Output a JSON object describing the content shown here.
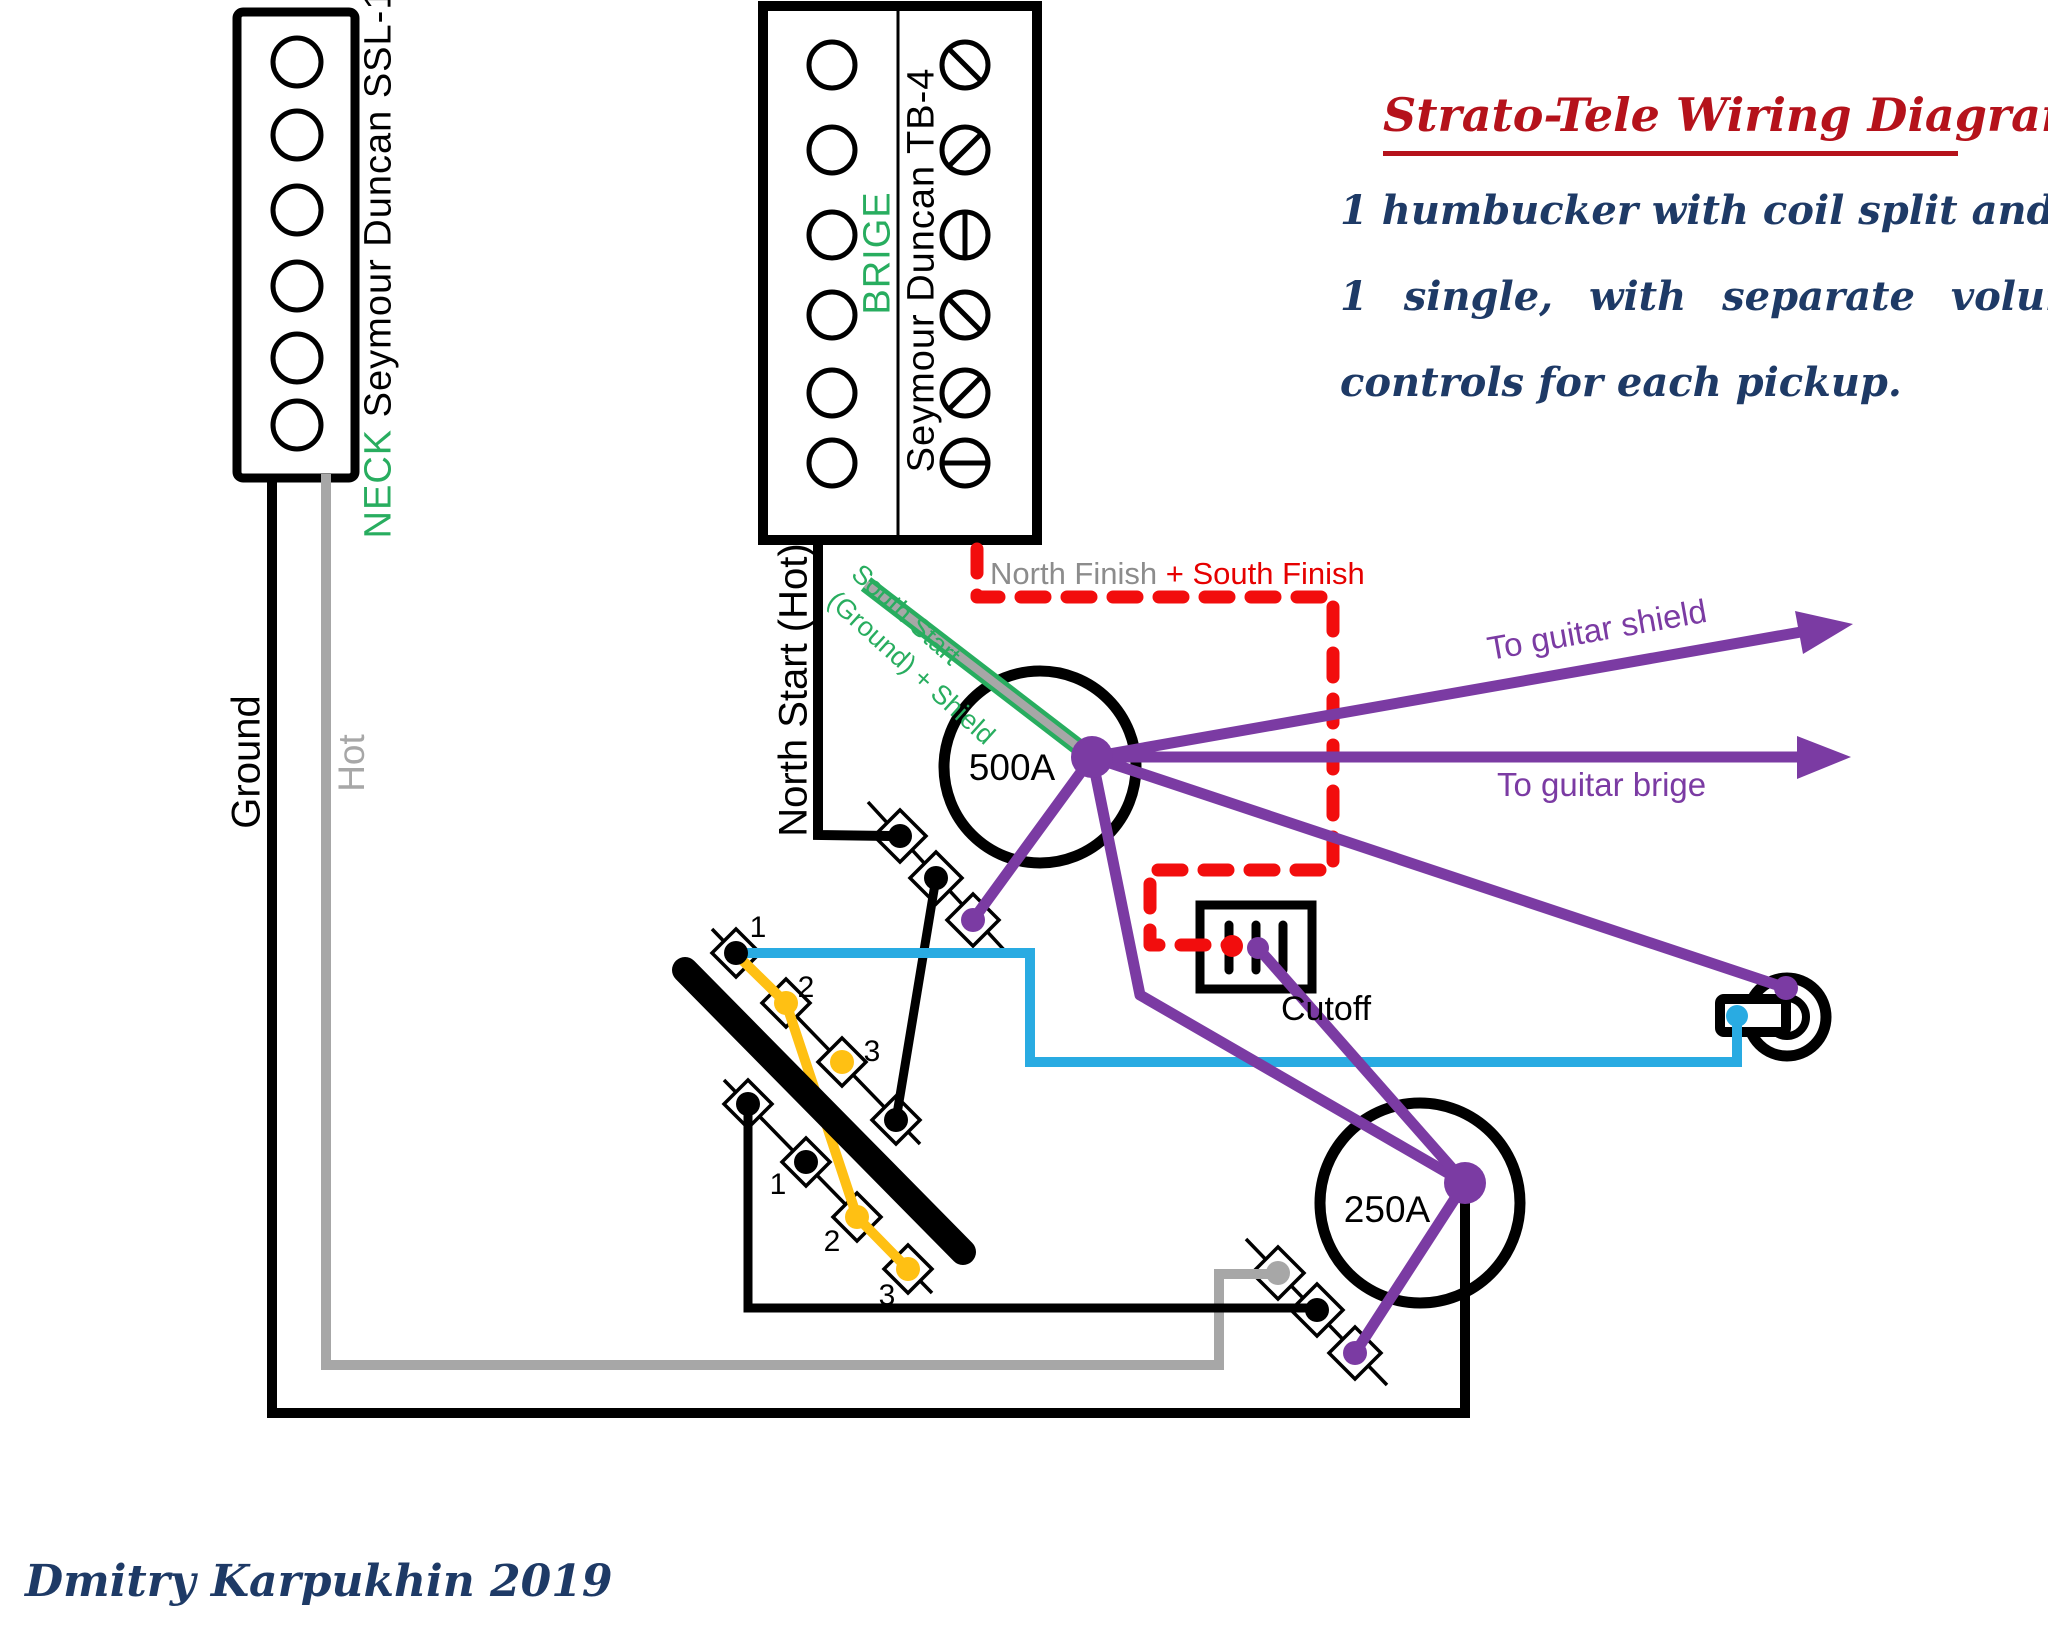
{
  "title": {
    "heading": "Strato-Tele Wiring Diagram",
    "line1": "1 humbucker with coil split and",
    "line2": "1 single, with separate volume",
    "line3": "controls for each pickup."
  },
  "signature": "Dmitry Karpukhin 2019",
  "pickups": {
    "neck": {
      "position": "NECK",
      "model": "Seymour Duncan SSL-1"
    },
    "bridge": {
      "position": "BRIGE",
      "model": "Seymour Duncan TB-4"
    }
  },
  "wire_labels": {
    "ground": "Ground",
    "hot": "Hot",
    "north_start": "North Start (Hot)",
    "south_start_line1": "South Start",
    "south_start_line2": "(Ground) + Shield",
    "north_finish": "North Finish ",
    "south_finish": "+ South Finish",
    "to_shield": "To guitar shield",
    "to_bridge": "To guitar brige"
  },
  "components": {
    "volume_bridge": "500A",
    "volume_neck": "250A",
    "cutoff": "Cutoff",
    "selector_top": [
      "1",
      "2",
      "3"
    ],
    "selector_bottom": [
      "1",
      "2",
      "3"
    ]
  },
  "colors": {
    "wire_black": "#000000",
    "wire_gray": "#A7A7A7",
    "wire_green": "#28AD5F",
    "wire_purple": "#7B3BA3",
    "wire_cyan": "#29ABE2",
    "wire_yellow": "#FFC013",
    "wire_red_dashed": "#F20D0D",
    "title_red": "#B5121B",
    "text_navy": "#1E3A66"
  }
}
